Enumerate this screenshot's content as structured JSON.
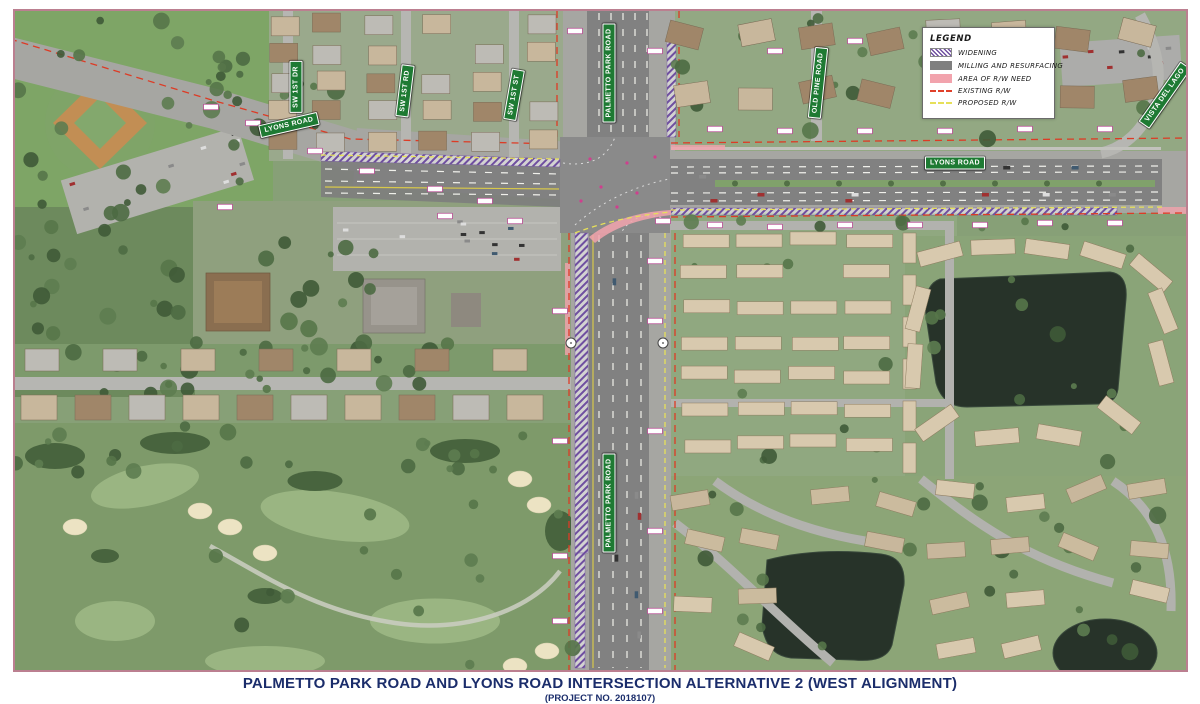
{
  "title_block": {
    "title": "PALMETTO PARK ROAD AND LYONS ROAD INTERSECTION ALTERNATIVE 2 (WEST ALIGNMENT)",
    "subtitle": "(PROJECT NO. 2018107)"
  },
  "legend": {
    "title": "LEGEND",
    "items": [
      {
        "label": "WIDENING",
        "swatch": "widening-hatch"
      },
      {
        "label": "MILLING AND RESURFACING",
        "swatch": "gray-fill"
      },
      {
        "label": "AREA OF R/W NEED",
        "swatch": "pink-fill"
      },
      {
        "label": "EXISTING R/W",
        "swatch": "red-dash-line"
      },
      {
        "label": "PROPOSED R/W",
        "swatch": "yellow-dash-line"
      }
    ]
  },
  "street_signs": {
    "lyons_road_west": "LYONS ROAD",
    "lyons_road_east": "LYONS ROAD",
    "sw_1st_dr": "SW 1ST DR",
    "sw_1st_rd": "SW 1ST RD",
    "sw_1st_st": "SW 1ST ST",
    "palmetto_park_road_north": "PALMETTO PARK ROAD",
    "palmetto_park_road_south": "PALMETTO PARK ROAD",
    "old_pine_road": "OLD PINE ROAD",
    "vista_del_lago": "VISTA DEL LAGO"
  },
  "colors": {
    "sign_green": "#1e7a33",
    "title_navy": "#1b2d6b",
    "widening": "#6f4fa0",
    "milling": "#7f7f7f",
    "rw_need": "#f2a3ad",
    "existing_rw": "#e0402a",
    "proposed_rw": "#e6e05a",
    "map_border": "#bb7f90"
  }
}
